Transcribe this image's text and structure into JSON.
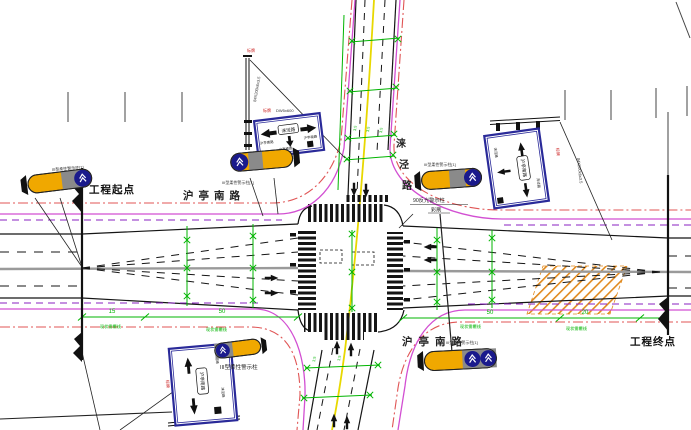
{
  "drawing": {
    "project_start": "工程起点",
    "project_end": "工程终点",
    "road_h_name": "沪亭南路",
    "road_v_chars": [
      "涞",
      "泾",
      "路"
    ],
    "post90_line1": "90反光警示柱",
    "post90_line2": "彩刷",
    "flex_post_label": "III型柔性警示柱",
    "flex_post_tag": "III型柔性警示柱[1]",
    "pole_spec": "84X200x6x3.5",
    "sign_tag": "标牌",
    "sign_code": "DW5x600",
    "marking_note": "现状需覆线",
    "dim_15": "15",
    "dim_50": "50",
    "dim_20": "20",
    "lane_width": "3.5"
  },
  "signs": {
    "guide_center": "涞泾路",
    "guide_side": "沪亭南路"
  },
  "colors": {
    "boundary_red": "#e05555",
    "curb_magenta": "#d24fd2",
    "line_purple": "#8820c0",
    "dim_green": "#00b400",
    "center_yellow": "#e8d800",
    "center_gray": "#9a9a9a",
    "hatch_orange": "#e0891e",
    "sign_blue": "#2a2a99",
    "barrel_yellow": "#f0a800",
    "barrel_gray": "#8a8a8a",
    "barrel_blue": "#1a1a8c",
    "tag_red": "#cc2222"
  }
}
